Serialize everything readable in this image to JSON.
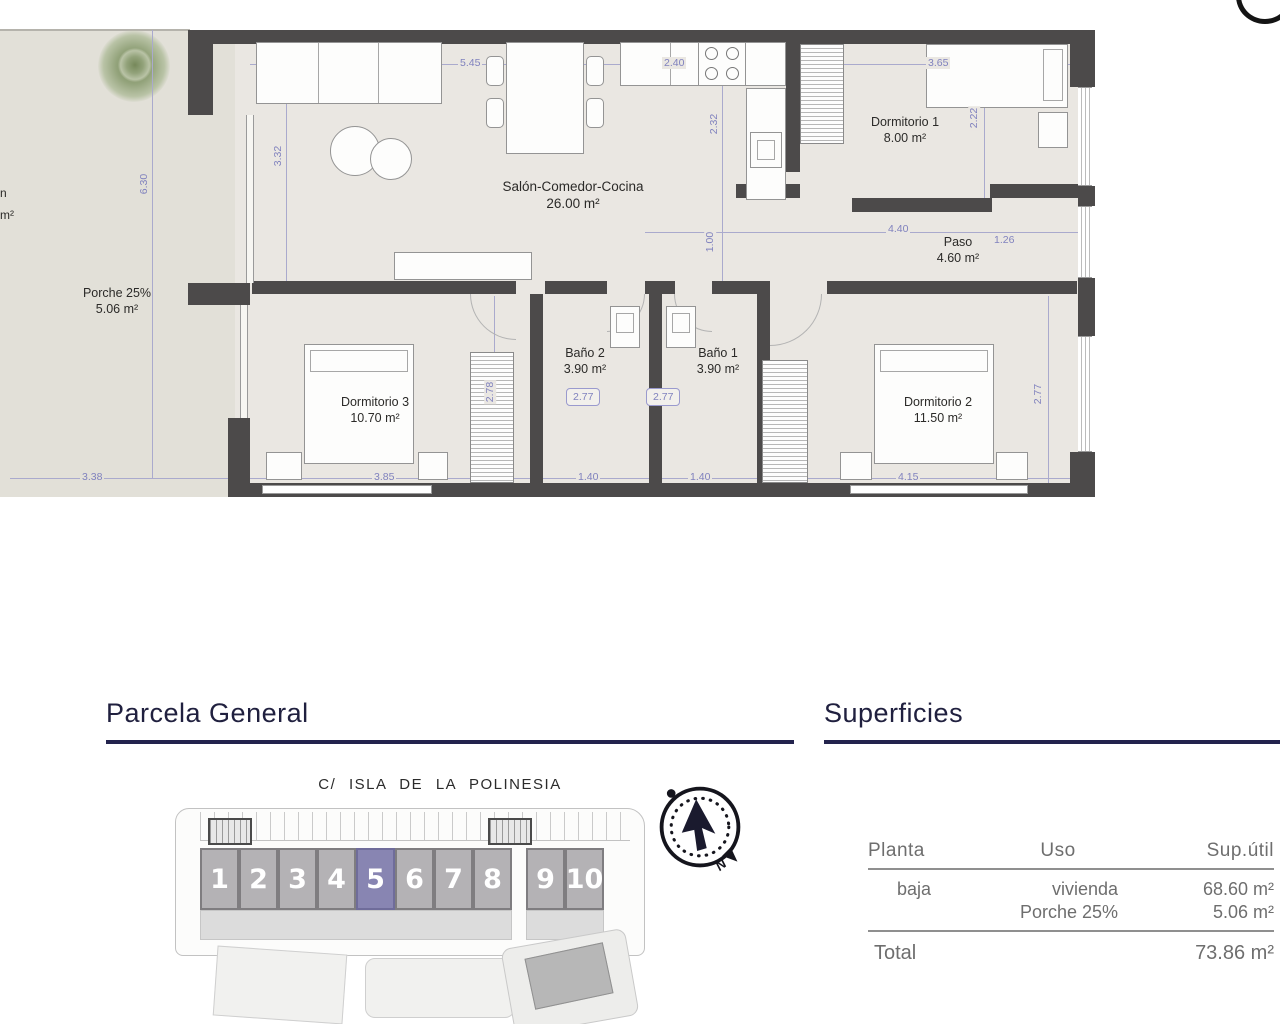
{
  "floor_plan": {
    "rooms": [
      {
        "name": "Salón-Comedor-Cocina",
        "area": "26.00 m²"
      },
      {
        "name": "Dormitorio 1",
        "area": "8.00 m²"
      },
      {
        "name": "Paso",
        "area": "4.60 m²"
      },
      {
        "name": "Baño 2",
        "area": "3.90 m²"
      },
      {
        "name": "Baño 1",
        "area": "3.90 m²"
      },
      {
        "name": "Dormitorio 3",
        "area": "10.70 m²"
      },
      {
        "name": "Dormitorio 2",
        "area": "11.50 m²"
      },
      {
        "name": "Porche 25%",
        "area": "5.06 m²"
      }
    ],
    "edge_text": {
      "line1": "n",
      "line2": "m²"
    },
    "dims": {
      "salon_w": "5.45",
      "kitchen_w": "2.40",
      "dorm1_w": "3.65",
      "kitchen_h": "2.32",
      "dorm1_h": "2.22",
      "salon_h": "3.32",
      "terrace_h": "6.30",
      "terrace_w": "3.38",
      "paso_w": "4.40",
      "paso_e": "1.26",
      "paso_h": "1.00",
      "dorm3_h": "2.78",
      "bano2_d": "2.77",
      "bano1_d": "2.77",
      "dorm2_h": "2.77",
      "bano2_w": "1.40",
      "bano1_w": "1.40",
      "dorm3_w": "3.85",
      "dorm2_w": "4.15"
    }
  },
  "parcela": {
    "title": "Parcela General",
    "street": "C/ ISLA DE LA POLINESIA",
    "units": [
      "1",
      "2",
      "3",
      "4",
      "5",
      "6",
      "7",
      "8",
      "9",
      "10"
    ],
    "highlighted_unit": "5",
    "compass": "N"
  },
  "superficies": {
    "title": "Superficies",
    "col_planta": "Planta",
    "col_uso": "Uso",
    "col_sup": "Sup.útil",
    "row_planta": "baja",
    "row_uso_1": "vivienda",
    "row_uso_2": "Porche 25%",
    "row_sup_1": "68.60 m²",
    "row_sup_2": "5.06 m²",
    "total_label": "Total",
    "total_value": "73.86 m²"
  },
  "colors": {
    "accent_navy": "#23234d",
    "dimension_blue": "#8082be",
    "wall": "#4c4a4a",
    "floor": "#eae7e2",
    "terrace": "#e2e0d8",
    "unit_gray": "#b4b2b5",
    "unit_highlight": "#8885b2"
  }
}
